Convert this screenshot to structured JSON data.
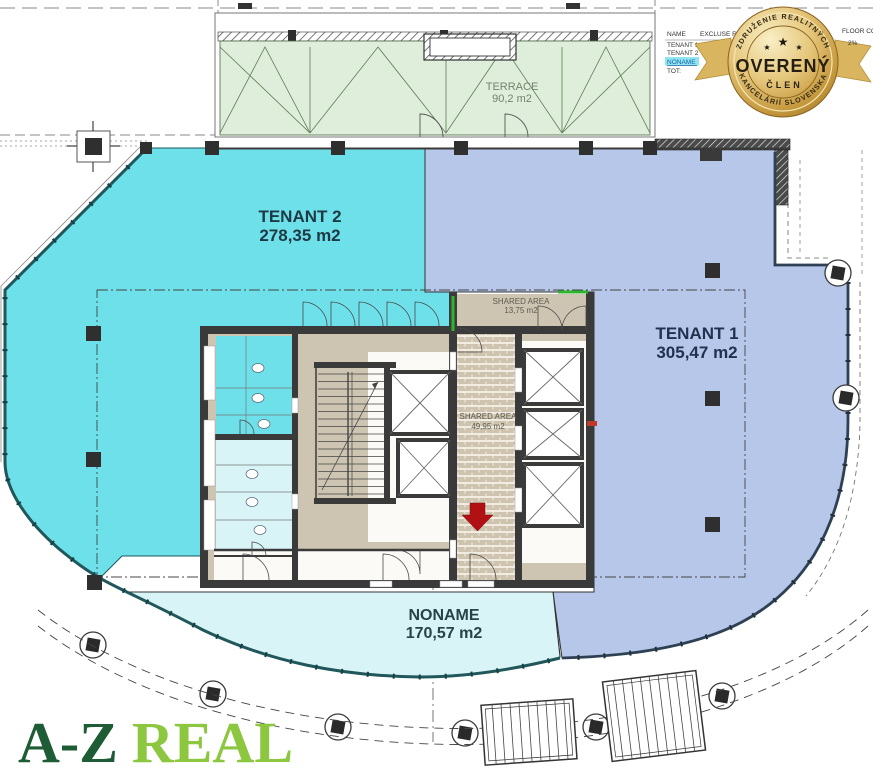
{
  "document": {
    "type": "floor-plan"
  },
  "areas": {
    "terrace": {
      "name": "TERRACE",
      "area": "90,2 m2"
    },
    "tenant2": {
      "name": "TENANT 2",
      "area": "278,35 m2"
    },
    "tenant1": {
      "name": "TENANT 1",
      "area": "305,47 m2"
    },
    "noname": {
      "name": "NONAME",
      "area": "170,57 m2"
    },
    "shared_small": {
      "name": "SHARED AREA",
      "area": "13,75 m2"
    },
    "shared_large": {
      "name": "SHARED AREA",
      "area": "49,95 m2"
    }
  },
  "legend": {
    "col_name": "NAME",
    "col_excluse": "EXCLUSE R",
    "col_floor": "FLOOR CO",
    "rows": [
      "TENANT 1",
      "TENANT 2",
      "NONAME",
      "TOT:"
    ],
    "floor_value": "2%"
  },
  "badge": {
    "arc_top": "ZDRUŽENIE REALITNÝCH",
    "title": "OVERENÝ",
    "member": "ČLEN",
    "arc_bottom": "KANCELÁRIÍ SLOVENSKA",
    "star": "★"
  },
  "logo": {
    "part1": "A-Z",
    "part2": "REAL",
    "color1": "#1d5c34",
    "color2": "#8dc63f"
  },
  "colors": {
    "tenant2": "#6ee0ea",
    "tenant1": "#b6c7e9",
    "noname": "#d9f4f7",
    "terrace": "#deeeda",
    "core": "#cec4b2",
    "wall": "#3a3a3a",
    "arrow": "#b21114",
    "badge_gold": "#d9b567"
  }
}
